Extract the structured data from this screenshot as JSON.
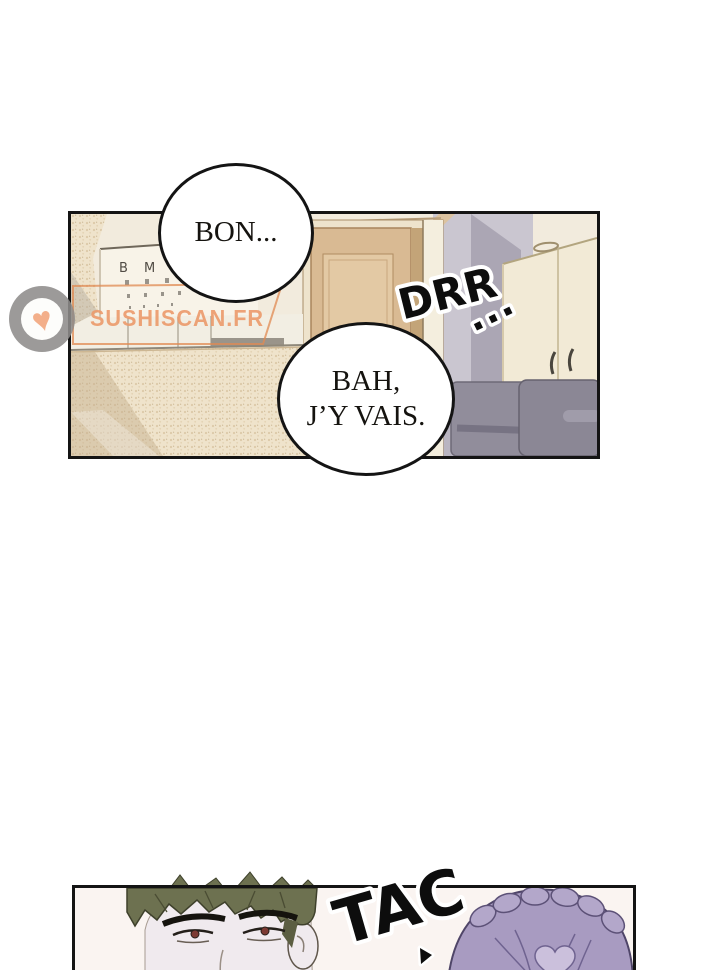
{
  "page": {
    "background": "#ffffff",
    "panel_border_color": "#141414"
  },
  "watermark": {
    "site_name": "SUSHISCAN.FR",
    "heart_icon": "♥",
    "accent_color": "#ec9a6b"
  },
  "colors": {
    "sfx_fill": "#0d0d0d",
    "sfx_outline": "#ffffff",
    "scene_wall_cream": "#f2ebdd",
    "scene_wall_lavender": "#cac6d0",
    "door_tan": "#d9ba93",
    "hair_olive": "#6d7150",
    "hair_purple": "#a89bc1",
    "panel2_background": "#faf4f1"
  },
  "panel1": {
    "scene": {
      "eye_chart_row1": "B M W"
    },
    "bubble_bon": {
      "text": "BON..."
    },
    "bubble_bah": {
      "line1": "BAH,",
      "line2": "J’Y VAIS."
    },
    "sfx_drr": {
      "text": "DRR",
      "dots": "..."
    }
  },
  "panel2": {
    "sfx_tac": {
      "text": "TAC"
    }
  }
}
